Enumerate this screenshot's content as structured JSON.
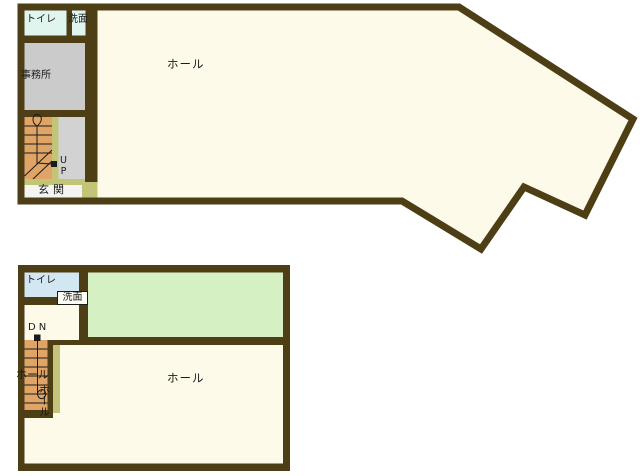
{
  "page": {
    "background": "#ffffff",
    "description_labels": {
      "up": "UP",
      "down": "DN"
    }
  },
  "colors": {
    "wall": "#4e3e15",
    "hall_floor": "#fdfae9",
    "toilet_1f": "#e0f5ee",
    "toilet_2f": "#d2e7f2",
    "office_gray": "#cbcbcb",
    "stair_orange": "#dfa466",
    "olive_strip": "#c2c578",
    "green_room": "#d5f1c4",
    "entrance_white": "#f4f4f1",
    "line_black": "#1b1b1b"
  },
  "floors": {
    "floor1": {
      "rooms": {
        "toilet": "トイレ",
        "washroom": "洗面",
        "office": "事務所",
        "hall": "ホール",
        "entrance": "玄関"
      },
      "stairs": {
        "direction_label": "UP"
      }
    },
    "floor2": {
      "rooms": {
        "toilet": "トイレ",
        "washroom": "洗面",
        "hall": "ホール"
      },
      "stairs": {
        "direction_label": "DN",
        "hall_label_horizontal": "ホール",
        "hall_label_vertical": "ホール"
      }
    }
  }
}
